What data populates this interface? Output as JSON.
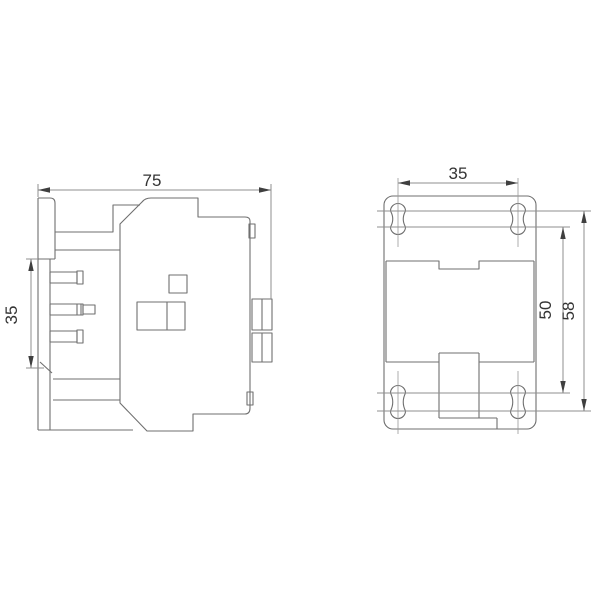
{
  "style": {
    "page_background": "#ffffff",
    "part_line_color": "#6f6f6f",
    "dimension_line_color": "#8f8f8f",
    "centerline_color": "#9a9a9a",
    "arrow_color": "#3f3f3f",
    "text_color": "#333333"
  },
  "side_view": {
    "width_dim": "75",
    "rail_mount_height_dim": "35"
  },
  "front_view": {
    "hole_spacing_dim": "35",
    "inner_hole_pitch_dim": "50",
    "outer_hole_pitch_dim": "58"
  }
}
